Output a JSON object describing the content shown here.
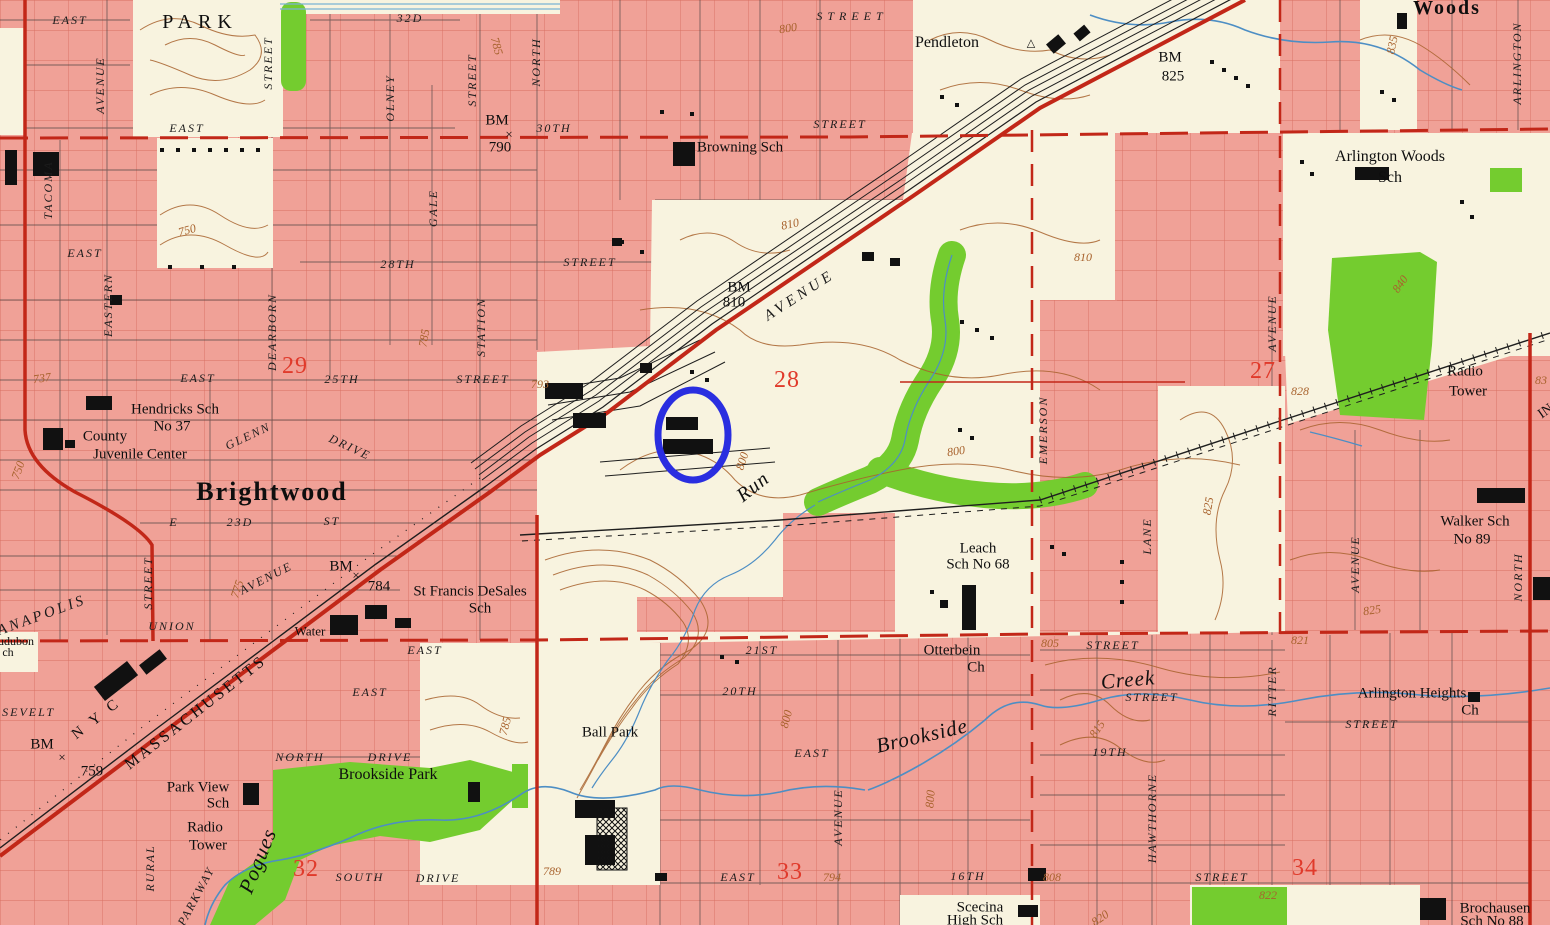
{
  "map": {
    "title": "USGS-style topographic map, Brightwood / Brookside area, Indianapolis",
    "colors": {
      "urban_pink": "#f0a197",
      "open_cream": "#f8f3df",
      "park_green": "#74cc2f",
      "water_blue": "#4d8ec4",
      "contour_brown": "#a8622d",
      "street_grid_red": "#c24536",
      "section_red": "#e03a2b",
      "road_red": "#c22718",
      "rail_black": "#1e1e1e",
      "annotation_blue": "#2a2ee0"
    },
    "annotation": {
      "shape": "ellipse",
      "cx": 693,
      "cy": 435,
      "rx": 35,
      "ry": 45,
      "color": "#2a2ee0",
      "stroke_width": 7,
      "note": "hand-drawn blue circle highlighting two black buildings south of the rail yard"
    },
    "section_numbers": [
      "29",
      "28",
      "27",
      "32",
      "33",
      "34"
    ],
    "benchmarks": [
      "BM 790",
      "BM 810",
      "BM 825",
      "BM 784",
      "BM 759"
    ],
    "labels": [
      {
        "t": "EAST",
        "x": 70,
        "y": 20,
        "c": "st"
      },
      {
        "t": "PARK",
        "x": 200,
        "y": 22,
        "c": "pl",
        "s": 20,
        "ls": 6
      },
      {
        "t": "32D",
        "x": 410,
        "y": 18,
        "c": "st"
      },
      {
        "t": "STREET",
        "x": 268,
        "y": 63,
        "c": "st",
        "r": -90
      },
      {
        "t": "AVENUE",
        "x": 100,
        "y": 85,
        "c": "st",
        "r": -90
      },
      {
        "t": "OLNEY",
        "x": 390,
        "y": 98,
        "c": "st",
        "r": -90
      },
      {
        "t": "STREET",
        "x": 472,
        "y": 80,
        "c": "st",
        "r": -90
      },
      {
        "t": "NORTH",
        "x": 536,
        "y": 62,
        "c": "st",
        "r": -90
      },
      {
        "t": "STREET",
        "x": 852,
        "y": 16,
        "c": "st",
        "ls": 5
      },
      {
        "t": "800",
        "x": 788,
        "y": 28,
        "c": "ct",
        "r": -8
      },
      {
        "t": "Pendleton",
        "x": 947,
        "y": 43,
        "c": "pl",
        "s": 16
      },
      {
        "t": "△",
        "x": 1031,
        "y": 44,
        "c": "pl",
        "s": 11
      },
      {
        "t": "BM",
        "x": 1170,
        "y": 58,
        "c": "pl",
        "s": 15
      },
      {
        "t": "825",
        "x": 1173,
        "y": 77,
        "c": "pl",
        "s": 15
      },
      {
        "t": "835",
        "x": 1392,
        "y": 45,
        "c": "ct",
        "r": -78
      },
      {
        "t": "Woods",
        "x": 1447,
        "y": 8,
        "c": "big",
        "s": 20
      },
      {
        "t": "ARLINGTON",
        "x": 1517,
        "y": 63,
        "c": "st",
        "r": -90
      },
      {
        "t": "Arlington Woods",
        "x": 1390,
        "y": 157,
        "c": "pl",
        "s": 16
      },
      {
        "t": "Sch",
        "x": 1390,
        "y": 178,
        "c": "pl",
        "s": 16
      },
      {
        "t": "840",
        "x": 1400,
        "y": 284,
        "c": "ct",
        "r": -55
      },
      {
        "t": "EAST",
        "x": 187,
        "y": 128,
        "c": "st"
      },
      {
        "t": "BM",
        "x": 497,
        "y": 121,
        "c": "pl",
        "s": 15
      },
      {
        "t": "×",
        "x": 509,
        "y": 134,
        "c": "pl",
        "s": 13
      },
      {
        "t": "790",
        "x": 500,
        "y": 148,
        "c": "pl",
        "s": 15
      },
      {
        "t": "30TH",
        "x": 554,
        "y": 128,
        "c": "st"
      },
      {
        "t": "Browning Sch",
        "x": 740,
        "y": 148,
        "c": "pl",
        "s": 15
      },
      {
        "t": "STREET",
        "x": 840,
        "y": 124,
        "c": "st"
      },
      {
        "t": "810",
        "x": 790,
        "y": 224,
        "c": "ct",
        "r": -12
      },
      {
        "t": "TACOMA",
        "x": 48,
        "y": 190,
        "c": "st",
        "r": -90
      },
      {
        "t": "EASTERN",
        "x": 108,
        "y": 305,
        "c": "st",
        "r": -90
      },
      {
        "t": "EAST",
        "x": 85,
        "y": 253,
        "c": "st"
      },
      {
        "t": "750",
        "x": 187,
        "y": 230,
        "c": "ct",
        "r": -15
      },
      {
        "t": "GALE",
        "x": 433,
        "y": 208,
        "c": "st",
        "r": -90
      },
      {
        "t": "28TH",
        "x": 398,
        "y": 264,
        "c": "st"
      },
      {
        "t": "STREET",
        "x": 590,
        "y": 262,
        "c": "st"
      },
      {
        "t": "29",
        "x": 295,
        "y": 366,
        "c": "sec"
      },
      {
        "t": "EAST",
        "x": 198,
        "y": 378,
        "c": "st"
      },
      {
        "t": "25TH",
        "x": 342,
        "y": 379,
        "c": "st"
      },
      {
        "t": "STREET",
        "x": 483,
        "y": 379,
        "c": "st"
      },
      {
        "t": "785",
        "x": 424,
        "y": 338,
        "c": "ct",
        "r": -80
      },
      {
        "t": "DEARBORN",
        "x": 272,
        "y": 332,
        "c": "st",
        "r": -90
      },
      {
        "t": "STATION",
        "x": 481,
        "y": 327,
        "c": "st",
        "r": -90
      },
      {
        "t": "737",
        "x": 42,
        "y": 378,
        "c": "ct",
        "r": -8
      },
      {
        "t": "Hendricks Sch",
        "x": 175,
        "y": 410,
        "c": "pl",
        "s": 15
      },
      {
        "t": "No 37",
        "x": 172,
        "y": 427,
        "c": "pl",
        "s": 15
      },
      {
        "t": "County",
        "x": 105,
        "y": 437,
        "c": "pl",
        "s": 15
      },
      {
        "t": "Juvenile Center",
        "x": 140,
        "y": 455,
        "c": "pl",
        "s": 15
      },
      {
        "t": "GLENN",
        "x": 248,
        "y": 436,
        "c": "st",
        "r": -25
      },
      {
        "t": "DRIVE",
        "x": 350,
        "y": 447,
        "c": "st",
        "r": 25
      },
      {
        "t": "Brightwood",
        "x": 272,
        "y": 492,
        "c": "big",
        "s": 26
      },
      {
        "t": "750",
        "x": 18,
        "y": 470,
        "c": "ct",
        "r": -70
      },
      {
        "t": "E",
        "x": 174,
        "y": 522,
        "c": "st"
      },
      {
        "t": "23D",
        "x": 240,
        "y": 522,
        "c": "st"
      },
      {
        "t": "ST",
        "x": 332,
        "y": 521,
        "c": "st"
      },
      {
        "t": "STREET",
        "x": 148,
        "y": 583,
        "c": "st",
        "r": -90
      },
      {
        "t": "775",
        "x": 237,
        "y": 589,
        "c": "ct",
        "r": -72
      },
      {
        "t": "AVENUE",
        "x": 266,
        "y": 578,
        "c": "st",
        "r": -27
      },
      {
        "t": "UNION",
        "x": 172,
        "y": 626,
        "c": "st"
      },
      {
        "t": "BM",
        "x": 341,
        "y": 567,
        "c": "pl",
        "s": 15
      },
      {
        "t": "×",
        "x": 356,
        "y": 575,
        "c": "pl",
        "s": 13
      },
      {
        "t": "784",
        "x": 379,
        "y": 587,
        "c": "pl",
        "s": 15
      },
      {
        "t": "St Francis DeSales",
        "x": 470,
        "y": 592,
        "c": "pl",
        "s": 15
      },
      {
        "t": "Sch",
        "x": 480,
        "y": 609,
        "c": "pl",
        "s": 15
      },
      {
        "t": "Water",
        "x": 310,
        "y": 631,
        "c": "pl",
        "s": 13
      },
      {
        "t": "ANAPOLIS",
        "x": 42,
        "y": 616,
        "c": "st",
        "r": -20,
        "s": 15,
        "ls": 3
      },
      {
        "t": "udubon",
        "x": 16,
        "y": 641,
        "c": "pl",
        "s": 12
      },
      {
        "t": "ch",
        "x": 8,
        "y": 652,
        "c": "pl",
        "s": 12
      },
      {
        "t": "OOSEVELT",
        "x": 18,
        "y": 712,
        "c": "st"
      },
      {
        "t": "N Y C",
        "x": 97,
        "y": 719,
        "c": "pl",
        "r": -38,
        "s": 15,
        "ls": 4
      },
      {
        "t": "MASSACHUSETTS",
        "x": 196,
        "y": 713,
        "c": "pl",
        "r": -38,
        "s": 16,
        "ls": 3
      },
      {
        "t": "BM",
        "x": 42,
        "y": 745,
        "c": "pl",
        "s": 15
      },
      {
        "t": "×",
        "x": 62,
        "y": 757,
        "c": "pl",
        "s": 13
      },
      {
        "t": "759",
        "x": 92,
        "y": 772,
        "c": "pl",
        "s": 15
      },
      {
        "t": "793",
        "x": 540,
        "y": 384,
        "c": "ct"
      },
      {
        "t": "28",
        "x": 787,
        "y": 380,
        "c": "sec"
      },
      {
        "t": "BM",
        "x": 739,
        "y": 288,
        "c": "pl",
        "s": 15
      },
      {
        "t": "810",
        "x": 734,
        "y": 303,
        "c": "pl",
        "s": 15
      },
      {
        "t": "AVENUE",
        "x": 800,
        "y": 296,
        "c": "st",
        "r": -33,
        "s": 15,
        "ls": 4
      },
      {
        "t": "800",
        "x": 742,
        "y": 461,
        "c": "ct",
        "r": -72
      },
      {
        "t": "Run",
        "x": 753,
        "y": 487,
        "c": "wtr",
        "s": 20,
        "r": -38
      },
      {
        "t": "800",
        "x": 956,
        "y": 451,
        "c": "ct",
        "r": -8
      },
      {
        "t": "Leach",
        "x": 978,
        "y": 549,
        "c": "pl",
        "s": 15
      },
      {
        "t": "Sch No 68",
        "x": 978,
        "y": 565,
        "c": "pl",
        "s": 15
      },
      {
        "t": "EMERSON",
        "x": 1043,
        "y": 430,
        "c": "st",
        "r": -90
      },
      {
        "t": "27",
        "x": 1263,
        "y": 371,
        "c": "sec"
      },
      {
        "t": "AVENUE",
        "x": 1272,
        "y": 323,
        "c": "st",
        "r": -90
      },
      {
        "t": "828",
        "x": 1300,
        "y": 391,
        "c": "ct"
      },
      {
        "t": "Radio",
        "x": 1465,
        "y": 372,
        "c": "pl",
        "s": 15
      },
      {
        "t": "Tower",
        "x": 1468,
        "y": 392,
        "c": "pl",
        "s": 15
      },
      {
        "t": "83",
        "x": 1541,
        "y": 380,
        "c": "ct"
      },
      {
        "t": "IN",
        "x": 1546,
        "y": 412,
        "c": "pl",
        "r": -35,
        "s": 14
      },
      {
        "t": "825",
        "x": 1208,
        "y": 506,
        "c": "ct",
        "r": -80
      },
      {
        "t": "LANE",
        "x": 1147,
        "y": 536,
        "c": "st",
        "r": -90
      },
      {
        "t": "Walker Sch",
        "x": 1475,
        "y": 522,
        "c": "pl",
        "s": 15
      },
      {
        "t": "No 89",
        "x": 1472,
        "y": 540,
        "c": "pl",
        "s": 15
      },
      {
        "t": "AVENUE",
        "x": 1355,
        "y": 564,
        "c": "st",
        "r": -90
      },
      {
        "t": "NORTH",
        "x": 1518,
        "y": 577,
        "c": "st",
        "r": -90
      },
      {
        "t": "825",
        "x": 1372,
        "y": 610,
        "c": "ct",
        "r": -8
      },
      {
        "t": "805",
        "x": 1050,
        "y": 643,
        "c": "ct"
      },
      {
        "t": "STREET",
        "x": 1113,
        "y": 645,
        "c": "st"
      },
      {
        "t": "Otterbein",
        "x": 952,
        "y": 651,
        "c": "pl",
        "s": 15
      },
      {
        "t": "Ch",
        "x": 976,
        "y": 668,
        "c": "pl",
        "s": 15
      },
      {
        "t": "21ST",
        "x": 762,
        "y": 650,
        "c": "st"
      },
      {
        "t": "20TH",
        "x": 740,
        "y": 691,
        "c": "st"
      },
      {
        "t": "EAST",
        "x": 812,
        "y": 753,
        "c": "st"
      },
      {
        "t": "800",
        "x": 786,
        "y": 719,
        "c": "ct",
        "r": -75
      },
      {
        "t": "Brookside",
        "x": 922,
        "y": 736,
        "c": "wtr",
        "s": 21,
        "r": -13
      },
      {
        "t": "Creek",
        "x": 1128,
        "y": 680,
        "c": "wtr",
        "s": 21,
        "r": -5
      },
      {
        "t": "STREET",
        "x": 1152,
        "y": 697,
        "c": "st"
      },
      {
        "t": "821",
        "x": 1300,
        "y": 640,
        "c": "ct"
      },
      {
        "t": "RITTER",
        "x": 1272,
        "y": 691,
        "c": "st",
        "r": -90
      },
      {
        "t": "Arlington Heights",
        "x": 1412,
        "y": 694,
        "c": "pl",
        "s": 15
      },
      {
        "t": "Ch",
        "x": 1470,
        "y": 711,
        "c": "pl",
        "s": 15
      },
      {
        "t": "STREET",
        "x": 1372,
        "y": 724,
        "c": "st"
      },
      {
        "t": "815",
        "x": 1097,
        "y": 729,
        "c": "ct",
        "r": -55
      },
      {
        "t": "19TH",
        "x": 1110,
        "y": 752,
        "c": "st"
      },
      {
        "t": "HAWTHORNE",
        "x": 1152,
        "y": 818,
        "c": "st",
        "r": -90
      },
      {
        "t": "AVENUE",
        "x": 838,
        "y": 817,
        "c": "st",
        "r": -90
      },
      {
        "t": "800",
        "x": 930,
        "y": 799,
        "c": "ct",
        "r": -85
      },
      {
        "t": "EAST",
        "x": 738,
        "y": 877,
        "c": "st"
      },
      {
        "t": "33",
        "x": 790,
        "y": 872,
        "c": "sec"
      },
      {
        "t": "794",
        "x": 832,
        "y": 877,
        "c": "ct"
      },
      {
        "t": "16TH",
        "x": 968,
        "y": 876,
        "c": "st"
      },
      {
        "t": "808",
        "x": 1052,
        "y": 877,
        "c": "ct"
      },
      {
        "t": "Scecina",
        "x": 980,
        "y": 908,
        "c": "pl",
        "s": 15
      },
      {
        "t": "High Sch",
        "x": 975,
        "y": 921,
        "c": "pl",
        "s": 15
      },
      {
        "t": "34",
        "x": 1305,
        "y": 868,
        "c": "sec"
      },
      {
        "t": "STREET",
        "x": 1222,
        "y": 877,
        "c": "st"
      },
      {
        "t": "822",
        "x": 1268,
        "y": 895,
        "c": "ct"
      },
      {
        "t": "Brochausen",
        "x": 1495,
        "y": 909,
        "c": "pl",
        "s": 15
      },
      {
        "t": "Sch No 88",
        "x": 1492,
        "y": 922,
        "c": "pl",
        "s": 15
      },
      {
        "t": "820",
        "x": 1100,
        "y": 918,
        "c": "ct",
        "r": -35
      },
      {
        "t": "789",
        "x": 552,
        "y": 871,
        "c": "ct"
      },
      {
        "t": "Ball Park",
        "x": 610,
        "y": 733,
        "c": "pl",
        "s": 15
      },
      {
        "t": "Park View",
        "x": 198,
        "y": 788,
        "c": "pl",
        "s": 15
      },
      {
        "t": "Sch",
        "x": 218,
        "y": 804,
        "c": "pl",
        "s": 15
      },
      {
        "t": "Brookside Park",
        "x": 388,
        "y": 775,
        "c": "pl",
        "s": 16
      },
      {
        "t": "NORTH",
        "x": 300,
        "y": 757,
        "c": "st"
      },
      {
        "t": "DRIVE",
        "x": 390,
        "y": 757,
        "c": "st"
      },
      {
        "t": "EAST",
        "x": 370,
        "y": 692,
        "c": "st"
      },
      {
        "t": "EAST",
        "x": 425,
        "y": 650,
        "c": "st"
      },
      {
        "t": "Radio",
        "x": 205,
        "y": 828,
        "c": "pl",
        "s": 15
      },
      {
        "t": "Tower",
        "x": 208,
        "y": 846,
        "c": "pl",
        "s": 15
      },
      {
        "t": "Pogues",
        "x": 258,
        "y": 861,
        "c": "wtr",
        "s": 21,
        "r": -68
      },
      {
        "t": "RURAL",
        "x": 150,
        "y": 868,
        "c": "st",
        "r": -90
      },
      {
        "t": "PARKWAY",
        "x": 196,
        "y": 896,
        "c": "st",
        "r": -62
      },
      {
        "t": "32",
        "x": 306,
        "y": 869,
        "c": "sec"
      },
      {
        "t": "SOUTH",
        "x": 360,
        "y": 877,
        "c": "st"
      },
      {
        "t": "DRIVE",
        "x": 438,
        "y": 878,
        "c": "st"
      },
      {
        "t": "785",
        "x": 505,
        "y": 726,
        "c": "ct",
        "r": -75
      },
      {
        "t": "785",
        "x": 497,
        "y": 46,
        "c": "ct",
        "r": 75
      },
      {
        "t": "810",
        "x": 1083,
        "y": 257,
        "c": "ct"
      }
    ]
  }
}
